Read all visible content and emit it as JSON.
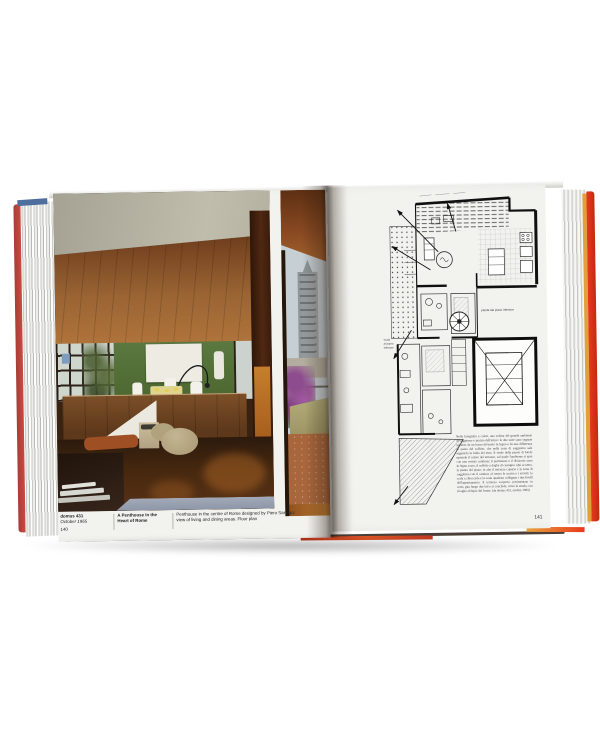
{
  "left_page": {
    "caption": {
      "issue": "domus 431",
      "date": "October 1965",
      "page_number": "140",
      "title_line1": "A Penthouse in the",
      "title_line2": "Heart of Rome",
      "desc_line1": "Penthouse in the centre of Rome designed by Piero Sartogo:",
      "desc_line2": "view of living and dining areas. Floor plan"
    }
  },
  "right_page": {
    "page_number": "141",
    "plan_label_center": "pianta del piano inferiore",
    "plan_label_left_1": "scala",
    "plan_label_left_2": "al piano",
    "plan_label_left_3": "inferiore",
    "body_text": "Nella fotografia a colori, una veduta del grande ambiente di soggiorno e pranzo dell'attico: le due zone sono segnate soltanto da un basso divisorio in legno e da una differenza di quota del soffitto, che nella zona di soggiorno sale seguendo la falda del tetto. Il verde della parete di fondo riprende il colore del terrazzo, sul quale l'ambiente si apre con una vetrata continua; il pavimento e il divisorio sono in legno scuro, il soffitto a doghe di castagno. Qui accanto, la pianta del piano: in alto il terrazzo coperto e la zona di soggiorno con il camino; al centro la cucina e i servizi; la scala a chiocciola e la scala quadrata collegano i due livelli dell'appartamento. Il terrazzo scoperto, pavimentato in cotto, gira lungo due lati e si conclude, verso la strada, con il taglio obliquo del fronte. (da domus 431, ottobre 1965)"
  },
  "colors": {
    "cover_red": "#e8391d",
    "cover_pink": "#c84b42",
    "edge_blue": "#4e6e9e",
    "edge_yellow": "#e0a13a",
    "paper": "#f2f2ef",
    "green_wall": "#5a7840",
    "wood_ceiling": "#b0743c",
    "floor_brown": "#46280f",
    "sky": "#c6cfd4",
    "bougainvillea": "#8d4c8d",
    "terrace_tile": "#a8663c",
    "bench_blue": "#8e97a8",
    "pouf": "#a89973",
    "cushion_rust": "#9e4f24"
  }
}
